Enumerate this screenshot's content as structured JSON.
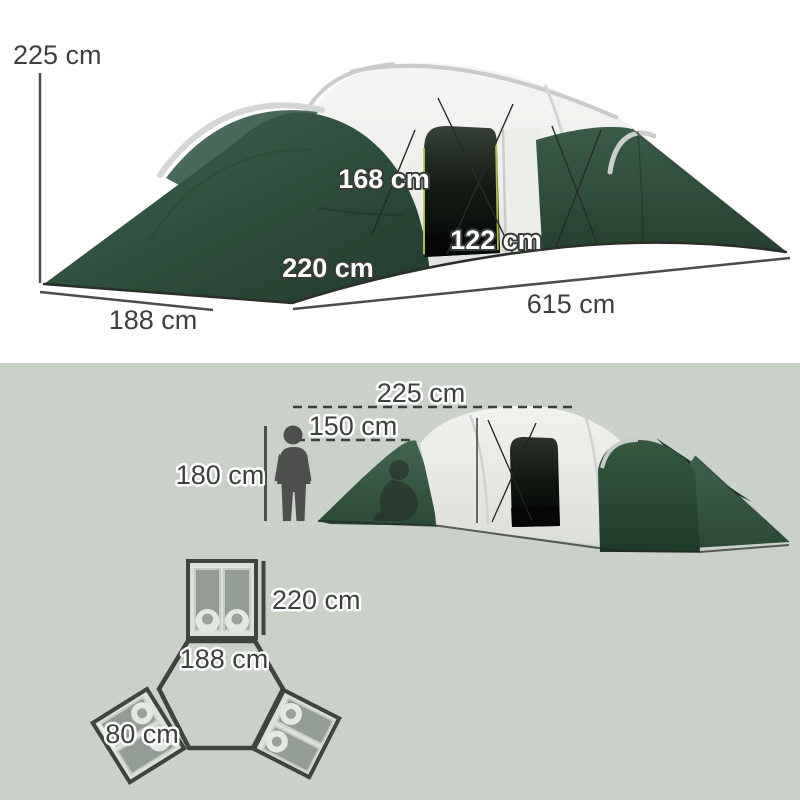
{
  "colors": {
    "background_top": "#ffffff",
    "background_bottom": "#c9d1c9",
    "tent_green_dark": "#2e4f3d",
    "fabric_white": "#f1f2ee",
    "door_dark": "#0a0f0a",
    "zip_accent": "#b9cc55",
    "label_dark": "#3f423e",
    "plan_outline": "#3f443e"
  },
  "top_diagram": {
    "tent_height_label": "225 cm",
    "inner_height_label": "168 cm",
    "door_height_label": "122 cm",
    "room_depth_label": "220 cm",
    "side_width_label": "188 cm",
    "total_length_label": "615 cm"
  },
  "side_view": {
    "peak_height_label": "225 cm",
    "wall_height_label": "150 cm",
    "person_height_label": "180 cm"
  },
  "floor_plan": {
    "bedroom_depth_label": "220 cm",
    "bedroom_width_label": "188 cm",
    "sleeping_bag_width_label": "80 cm"
  }
}
